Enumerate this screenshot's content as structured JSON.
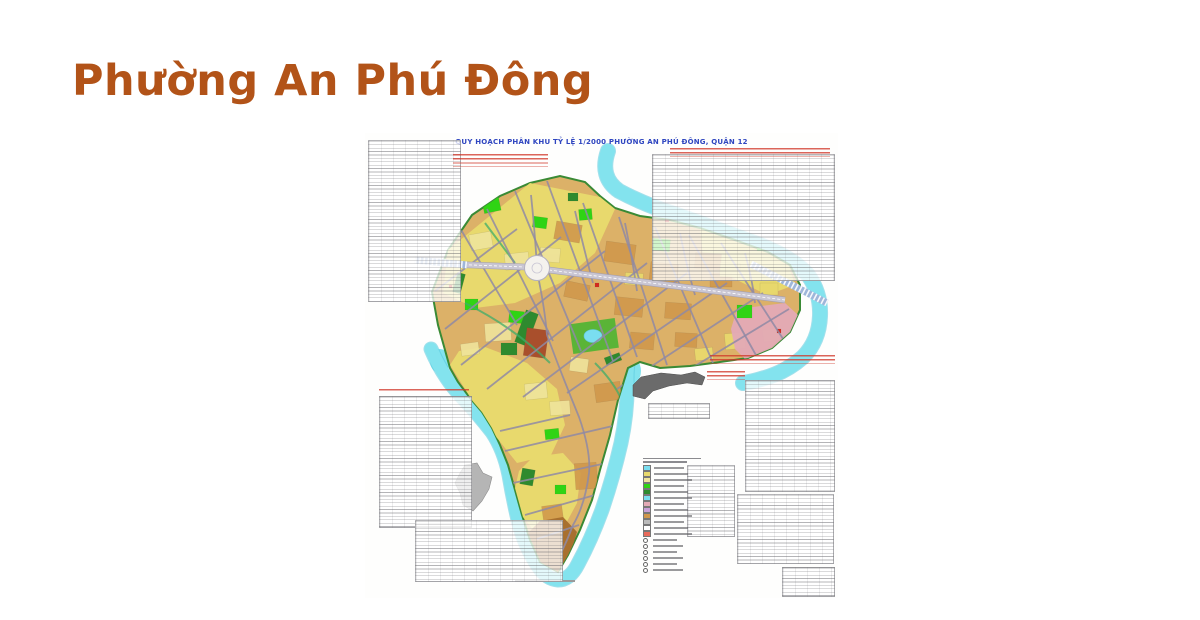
{
  "page": {
    "title": "Phường An Phú Đông",
    "title_color": "#b25318",
    "background": "#ffffff"
  },
  "map_sheet": {
    "title": "QUY HOẠCH PHÂN KHU TỶ LỆ 1/2000 PHƯỜNG AN PHÚ ĐÔNG, QUẬN 12",
    "title_color": "#2f46c0",
    "annotation_color": "#cf3a2c",
    "colors": {
      "river": "#83e3ee",
      "river_edge": "#54c7dc",
      "ward_base": "#dcb168",
      "ward_border_green": "#3a8a35",
      "parcel_yellow": "#e8d96d",
      "parcel_pale_yellow": "#efe49c",
      "parcel_tan": "#d0974b",
      "park_bright_green": "#2fd414",
      "park_dark_green": "#2e8a2e",
      "zone_pink": "#e3aab6",
      "special_red_brown": "#a94f2c",
      "tail_brown": "#a8702f",
      "road_gray": "#8f8aa5",
      "arterial_fill": "#c9c6d3",
      "arterial_edge": "#a39fb3",
      "bridge_blue": "#9fb6da",
      "inset_gray": "#b5b5b5",
      "blob_gray": "#6b6b6b",
      "dot_red": "#d42a1e",
      "pond_cyan": "#7adef0",
      "park_mid_green": "#5ab437"
    },
    "legend_swatches": [
      "#7adef0",
      "#e8d96d",
      "#efe49c",
      "#2fd414",
      "#2e8a2e",
      "#7adef0",
      "#e3aab6",
      "#c9a0d8",
      "#d0974b",
      "#bbbbbb",
      "#ffffff",
      "#e86a5a"
    ],
    "panels": [
      {
        "name": "stats-table-top-left",
        "x": 3,
        "y": 7,
        "w": 93,
        "h": 162
      },
      {
        "name": "stats-table-top-right",
        "x": 287,
        "y": 21,
        "w": 183,
        "h": 127
      },
      {
        "name": "stats-table-right-tall",
        "x": 380,
        "y": 247,
        "w": 90,
        "h": 112
      },
      {
        "name": "stats-table-right-mid",
        "x": 372,
        "y": 361,
        "w": 97,
        "h": 70
      },
      {
        "name": "stats-table-right-small",
        "x": 417,
        "y": 434,
        "w": 53,
        "h": 30
      },
      {
        "name": "stats-table-left",
        "x": 14,
        "y": 263,
        "w": 93,
        "h": 132
      },
      {
        "name": "stats-table-bottom-wide",
        "x": 50,
        "y": 387,
        "w": 148,
        "h": 62
      },
      {
        "name": "stats-table-center-small",
        "x": 283,
        "y": 270,
        "w": 62,
        "h": 16
      },
      {
        "name": "legend-table",
        "x": 322,
        "y": 332,
        "w": 48,
        "h": 72
      }
    ],
    "red_blocks": [
      {
        "name": "red-note-left",
        "x": 88,
        "y": 21,
        "w": 95,
        "h": 13
      },
      {
        "name": "red-note-right-top",
        "x": 305,
        "y": 15,
        "w": 160,
        "h": 9
      },
      {
        "name": "red-note-above-blob",
        "x": 345,
        "y": 222,
        "w": 125,
        "h": 9
      },
      {
        "name": "red-note-right-of-blob",
        "x": 342,
        "y": 238,
        "w": 38,
        "h": 9
      },
      {
        "name": "red-note-left-table-header",
        "x": 14,
        "y": 256,
        "w": 90,
        "h": 4
      }
    ],
    "geometry": {
      "ward_outline": "M 67,159 L 73,192 L 80,217 L 85,235 L 93,249 L 105,265 L 117,279 L 127,295 L 135,312 L 143,332 L 150,357 L 157,382 L 165,407 L 175,429 L 193,439 L 203,422 L 215,397 L 227,367 L 235,337 L 245,302 L 253,267 L 263,235 L 275,229 L 295,235 L 325,233 L 355,229 L 383,225 L 407,215 L 425,199 L 435,177 L 435,152 L 425,132 L 403,119 L 370,107 L 335,95 L 305,87 L 275,83 L 250,75 L 235,63 L 220,49 L 195,43 L 165,50 L 135,63 L 107,82 L 83,117 Z",
      "river_paths": [
        {
          "d": "M 243,18 Q 234,44 254,58 Q 280,72 315,83 Q 355,97 395,112 Q 428,125 443,142 Q 456,160 455,183 Q 454,208 438,224 Q 420,240 396,246 Q 386,249 378,250",
          "w": 14
        },
        {
          "d": "M 66,216 Q 78,244 96,263 Q 113,281 127,299 Q 139,317 144,342 Q 148,366 154,391 Q 161,416 173,433 Q 181,446 193,447 Q 205,447 213,431 Q 226,407 237,377 Q 248,345 256,310 Q 263,277 262,246 Q 262,233 264,225",
          "w": 13
        }
      ],
      "river_blobs": [
        {
          "cx": 262,
          "cy": 238,
          "rx": 14,
          "ry": 16
        },
        {
          "cx": 75,
          "cy": 228,
          "rx": 10,
          "ry": 12
        }
      ],
      "yellow_regions": [
        "M 83,117 L 165,50 L 235,64 L 250,76 L 230,120 L 195,150 L 150,170 L 110,175 L 78,160 Z",
        "M 85,232 L 110,272 L 132,305 L 152,330 L 186,322 L 200,292 L 192,256 L 162,230 L 120,214 L 94,218 Z",
        "M 150,355 L 158,384 L 172,402 L 198,396 L 212,370 L 216,340 L 198,320 L 168,324 L 154,338 Z",
        "M 335,96 L 402,120 L 424,133 L 430,152 L 402,162 L 362,142 L 338,122 Z"
      ],
      "pink_zone": "M 372,176 L 420,170 L 433,182 L 434,202 L 424,218 L 404,228 L 384,230 L 370,216 L 366,196 Z",
      "tail_brown_patch": "M 163,400 L 176,430 L 193,440 L 205,422 L 212,399 L 198,384 L 175,388 Z",
      "tan_rects": [
        [
          190,
          90,
          26,
          18,
          10
        ],
        [
          240,
          110,
          30,
          20,
          8
        ],
        [
          285,
          130,
          28,
          18,
          6
        ],
        [
          330,
          120,
          26,
          16,
          4
        ],
        [
          200,
          150,
          24,
          16,
          12
        ],
        [
          250,
          165,
          28,
          18,
          6
        ],
        [
          300,
          170,
          26,
          16,
          4
        ],
        [
          345,
          140,
          22,
          14,
          0
        ],
        [
          230,
          250,
          26,
          18,
          -8
        ],
        [
          250,
          300,
          24,
          30,
          -6
        ],
        [
          210,
          330,
          22,
          26,
          -4
        ],
        [
          178,
          372,
          20,
          22,
          -8
        ],
        [
          265,
          200,
          24,
          16,
          5
        ],
        [
          310,
          200,
          22,
          14,
          3
        ]
      ],
      "pale_rects": [
        [
          105,
          100,
          22,
          16,
          -10
        ],
        [
          140,
          120,
          24,
          16,
          -6
        ],
        [
          175,
          115,
          20,
          14,
          5
        ],
        [
          120,
          190,
          26,
          18,
          -4
        ],
        [
          160,
          250,
          22,
          16,
          -6
        ],
        [
          185,
          268,
          20,
          14,
          -4
        ],
        [
          205,
          225,
          18,
          14,
          8
        ],
        [
          96,
          210,
          18,
          12,
          -8
        ]
      ],
      "yellow_rects": [
        [
          355,
          130,
          20,
          14,
          3
        ],
        [
          395,
          150,
          18,
          12,
          0
        ],
        [
          360,
          200,
          20,
          16,
          -5
        ],
        [
          330,
          215,
          18,
          12,
          -6
        ],
        [
          398,
          196,
          16,
          12,
          -8
        ],
        [
          260,
          140,
          18,
          12,
          4
        ]
      ],
      "bright_green_rects": [
        [
          118,
          66,
          17,
          13,
          -12
        ],
        [
          168,
          84,
          14,
          11,
          8
        ],
        [
          214,
          76,
          13,
          11,
          -5
        ],
        [
          288,
          106,
          17,
          12,
          5
        ],
        [
          392,
          109,
          11,
          9,
          0
        ],
        [
          100,
          166,
          13,
          11,
          0
        ],
        [
          144,
          178,
          15,
          12,
          6
        ],
        [
          372,
          172,
          15,
          13,
          0
        ],
        [
          180,
          296,
          14,
          10,
          -6
        ],
        [
          190,
          352,
          11,
          9,
          0
        ],
        [
          70,
          120,
          10,
          9,
          0
        ]
      ],
      "dark_green_rects": [
        [
          155,
          178,
          13,
          34,
          20
        ],
        [
          136,
          210,
          16,
          12,
          0
        ],
        [
          156,
          336,
          13,
          16,
          10
        ],
        [
          203,
          60,
          10,
          8,
          0
        ],
        [
          240,
          222,
          16,
          8,
          -20
        ],
        [
          90,
          140,
          8,
          20,
          15
        ]
      ],
      "special_rects": [
        [
          160,
          196,
          22,
          28,
          8,
          "#a94f2c"
        ],
        [
          230,
          150,
          4,
          4,
          0,
          "#d42a1e"
        ],
        [
          412,
          196,
          4,
          4,
          0,
          "#d42a1e"
        ],
        [
          300,
          86,
          4,
          3,
          0,
          "#d42a1e"
        ],
        [
          84,
          152,
          3,
          3,
          0,
          "#d42a1e"
        ]
      ],
      "park_rect": [
        206,
        188,
        46,
        30,
        -8
      ],
      "pond": {
        "cx": 228,
        "cy": 203,
        "rx": 9,
        "ry": 6.5
      },
      "streams": [
        "M 100,170 Q 150,195 185,230",
        "M 230,230 Q 250,250 258,270",
        "M 120,90 Q 135,110 150,130"
      ],
      "roads": [
        "M 95,95 L 152,192",
        "M 122,76 L 188,208",
        "M 150,58 L 216,218",
        "M 182,48 L 248,228",
        "M 218,70 L 272,224",
        "M 254,84 L 302,232",
        "M 290,94 L 348,230",
        "M 324,102 L 392,224",
        "M 356,110 L 422,212",
        "M 70,158 L 152,96",
        "M 80,196 L 196,104",
        "M 96,232 L 240,118",
        "M 122,256 L 282,130",
        "M 158,264 L 322,140",
        "M 202,260 L 362,150",
        "M 252,256 L 398,160",
        "M 302,250 L 424,176",
        "M 166,62 Q 170,100 172,135",
        "M 174,148 Q 180,178 182,202",
        "M 182,202 Q 196,240 214,284 Q 226,318 224,340 Q 220,372 208,392 Q 202,408 196,420",
        "M 140,318 L 252,292",
        "M 148,350 L 242,330",
        "M 160,382 L 230,362",
        "M 172,406 L 214,392",
        "M 135,298 L 205,282",
        "M 210,78 Q 220,120 228,150",
        "M 260,90 Q 268,130 272,158",
        "M 315,100 Q 322,135 330,162",
        "M 380,120 Q 388,150 390,170"
      ],
      "arterial": [
        "M 54,130 L 160,134",
        "M 184,137 L 420,167"
      ],
      "roundabout": {
        "cx": 172,
        "cy": 135,
        "r": 12.5
      },
      "bridges": [
        "M 50,127 L 102,132",
        "M 386,131 L 462,170"
      ],
      "inset_map": "M 100,332 L 112,330 L 118,340 L 127,344 L 124,356 L 117,368 L 108,378 L 98,372 L 95,360 L 90,350 L 95,340 Z",
      "blob_3d": "M 268,252 L 276,244 L 296,240 L 316,242 L 330,239 L 340,244 L 337,252 L 322,250 L 304,253 L 288,258 L 280,266 L 268,263 Z",
      "scale_bar": {
        "x": 150,
        "y": 447,
        "w": 60,
        "h": 2
      }
    }
  }
}
